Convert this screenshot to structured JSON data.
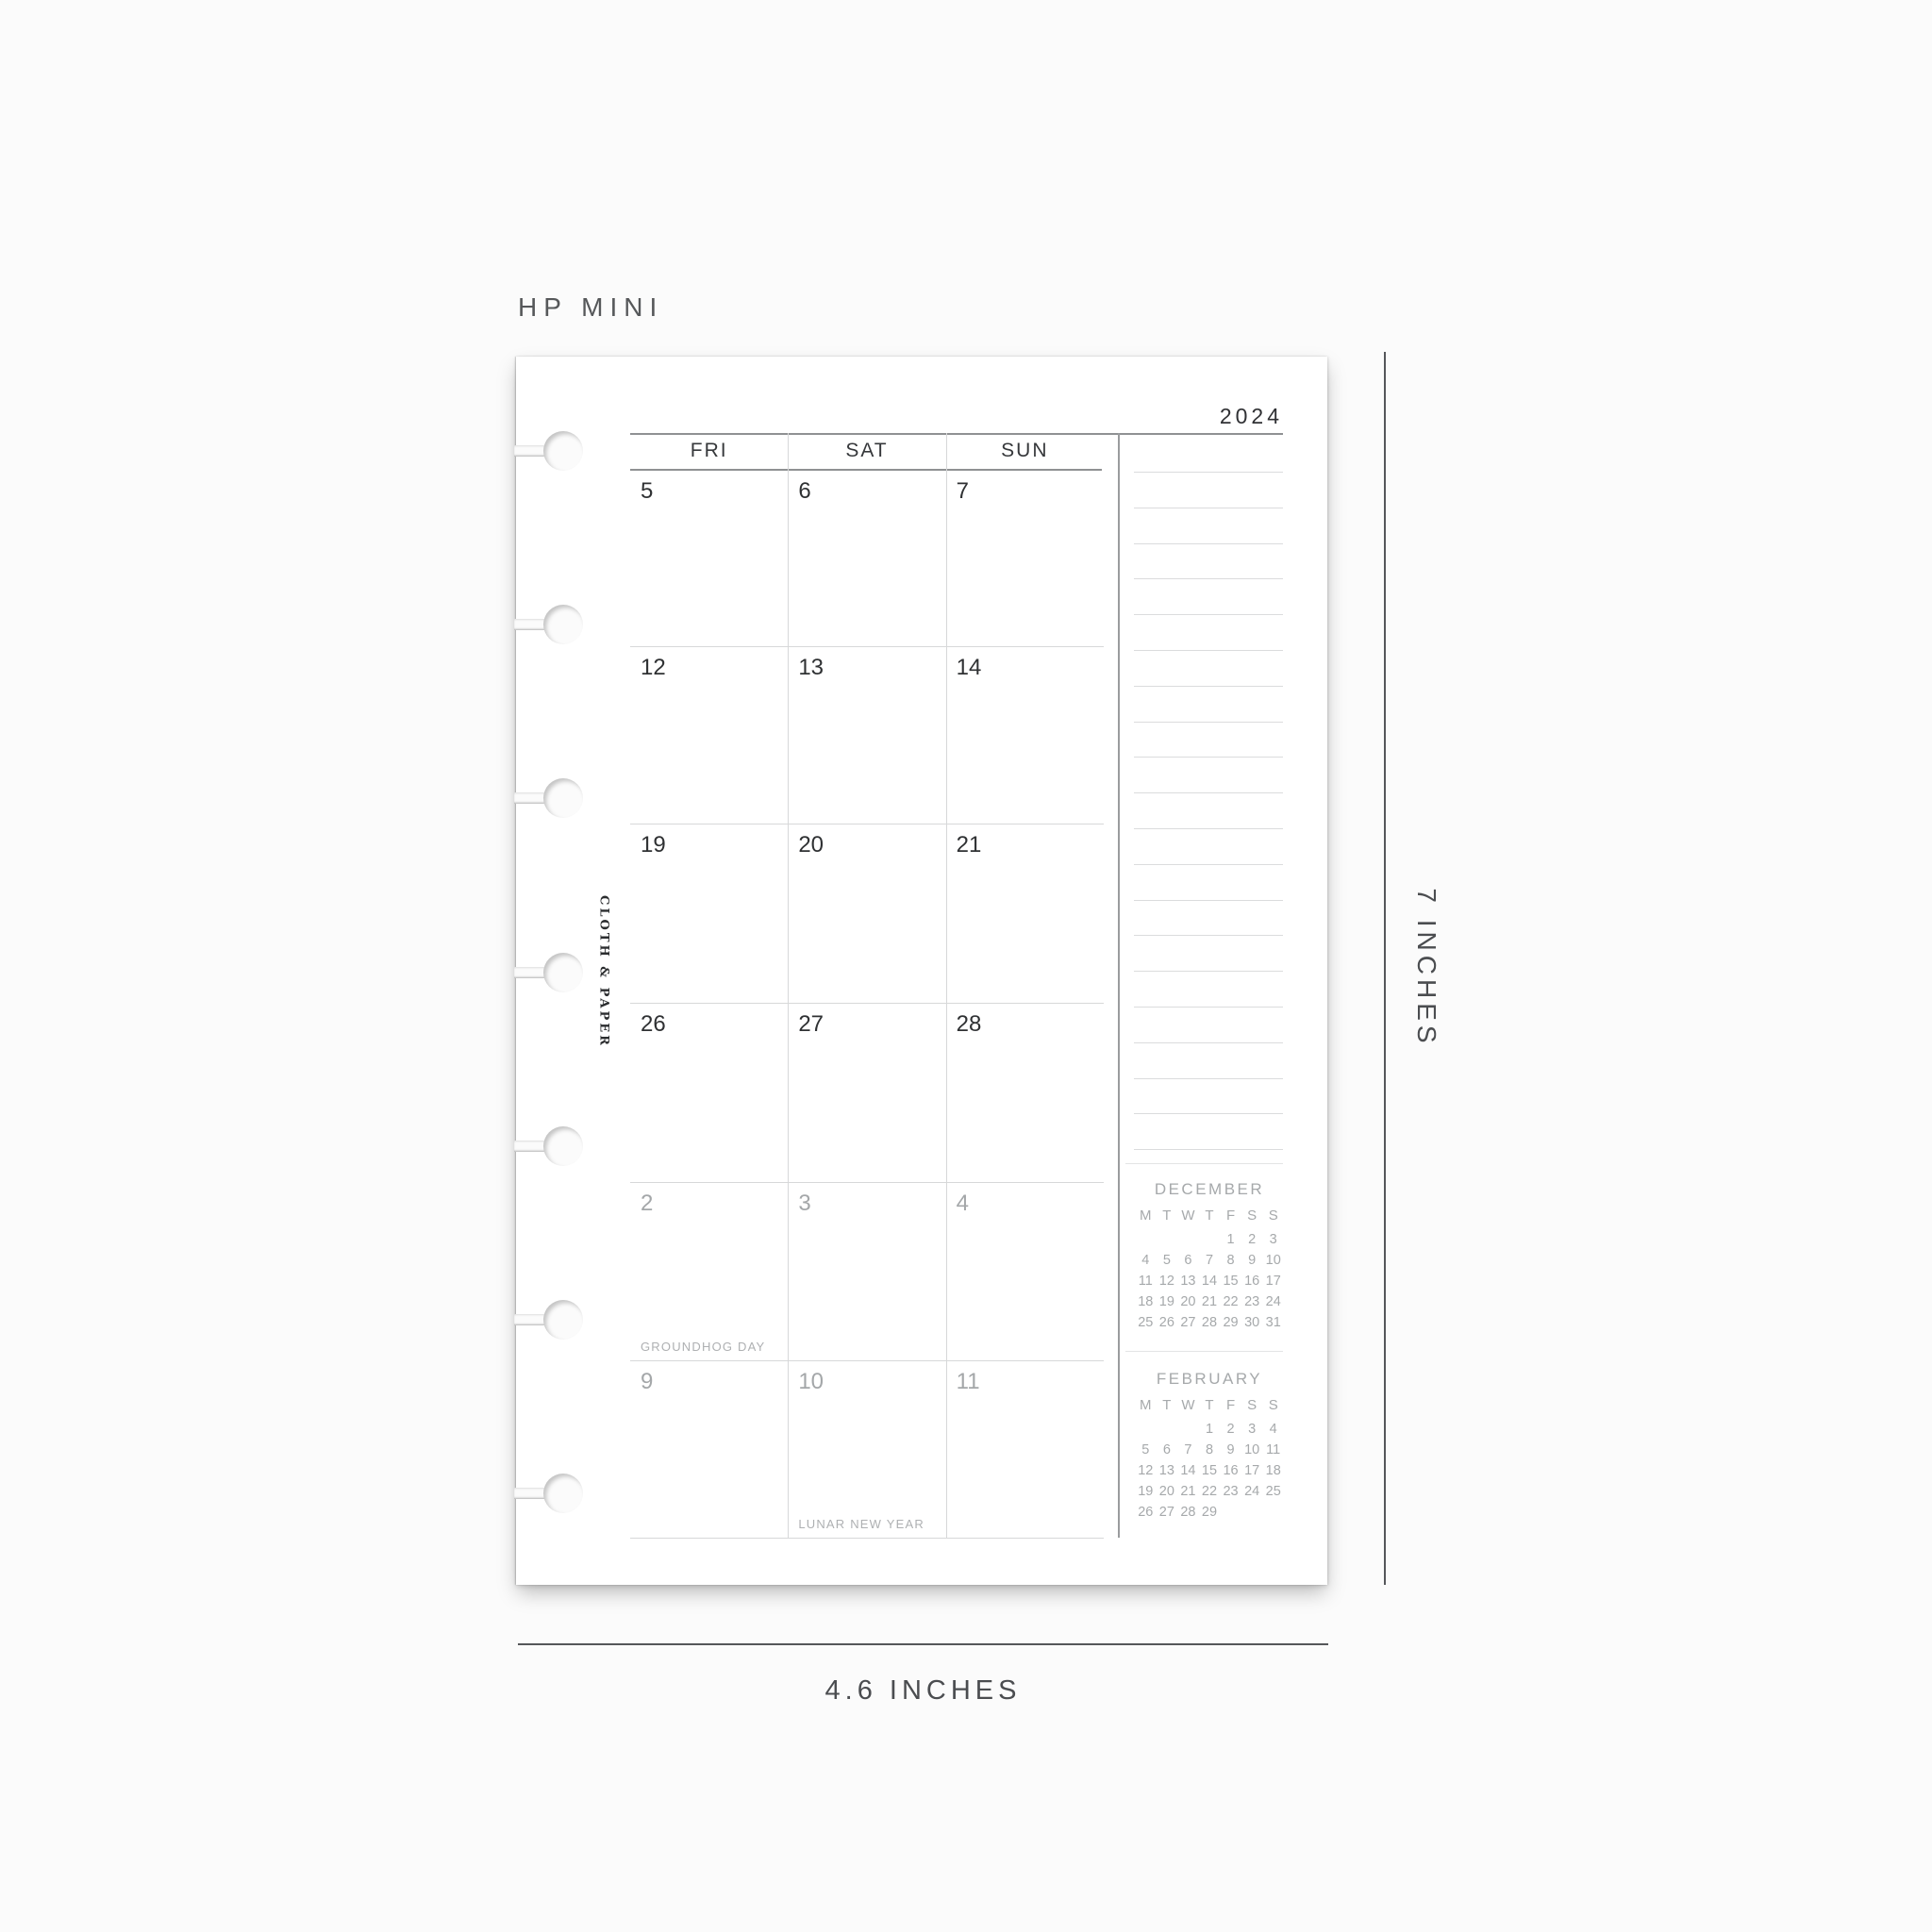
{
  "annotations": {
    "size_label": "HP MINI",
    "height_label": "7 INCHES",
    "width_label": "4.6 INCHES"
  },
  "page": {
    "year": "2024",
    "brand": "CLOTH & PAPER",
    "weekday_headers": [
      "FRI",
      "SAT",
      "SUN"
    ],
    "grid_rows": [
      {
        "muted": false,
        "days": [
          {
            "num": "5",
            "holiday": ""
          },
          {
            "num": "6",
            "holiday": ""
          },
          {
            "num": "7",
            "holiday": ""
          }
        ]
      },
      {
        "muted": false,
        "days": [
          {
            "num": "12",
            "holiday": ""
          },
          {
            "num": "13",
            "holiday": ""
          },
          {
            "num": "14",
            "holiday": ""
          }
        ]
      },
      {
        "muted": false,
        "days": [
          {
            "num": "19",
            "holiday": ""
          },
          {
            "num": "20",
            "holiday": ""
          },
          {
            "num": "21",
            "holiday": ""
          }
        ]
      },
      {
        "muted": false,
        "days": [
          {
            "num": "26",
            "holiday": ""
          },
          {
            "num": "27",
            "holiday": ""
          },
          {
            "num": "28",
            "holiday": ""
          }
        ]
      },
      {
        "muted": true,
        "days": [
          {
            "num": "2",
            "holiday": "GROUNDHOG DAY"
          },
          {
            "num": "3",
            "holiday": ""
          },
          {
            "num": "4",
            "holiday": ""
          }
        ]
      },
      {
        "muted": true,
        "days": [
          {
            "num": "9",
            "holiday": ""
          },
          {
            "num": "10",
            "holiday": "LUNAR NEW YEAR"
          },
          {
            "num": "11",
            "holiday": ""
          }
        ]
      }
    ],
    "notes_line_count": 20,
    "mini_calendars": [
      {
        "title": "DECEMBER",
        "weekdays": [
          "M",
          "T",
          "W",
          "T",
          "F",
          "S",
          "S"
        ],
        "weeks": [
          [
            "",
            "",
            "",
            "",
            "1",
            "2",
            "3"
          ],
          [
            "4",
            "5",
            "6",
            "7",
            "8",
            "9",
            "10"
          ],
          [
            "11",
            "12",
            "13",
            "14",
            "15",
            "16",
            "17"
          ],
          [
            "18",
            "19",
            "20",
            "21",
            "22",
            "23",
            "24"
          ],
          [
            "25",
            "26",
            "27",
            "28",
            "29",
            "30",
            "31"
          ]
        ]
      },
      {
        "title": "FEBRUARY",
        "weekdays": [
          "M",
          "T",
          "W",
          "T",
          "F",
          "S",
          "S"
        ],
        "weeks": [
          [
            "",
            "",
            "",
            "1",
            "2",
            "3",
            "4"
          ],
          [
            "5",
            "6",
            "7",
            "8",
            "9",
            "10",
            "11"
          ],
          [
            "12",
            "13",
            "14",
            "15",
            "16",
            "17",
            "18"
          ],
          [
            "19",
            "20",
            "21",
            "22",
            "23",
            "24",
            "25"
          ],
          [
            "26",
            "27",
            "28",
            "29",
            "",
            "",
            ""
          ]
        ]
      }
    ],
    "disc_notch_count": 7
  },
  "colors": {
    "background": "#fbfbfb",
    "paper": "#ffffff",
    "ink_dark": "#2f3133",
    "ink_muted": "#a4a7a9",
    "grid_line_light": "#d7d8d9",
    "grid_line_dark": "#8f9193",
    "annotation": "#4b4d50"
  }
}
